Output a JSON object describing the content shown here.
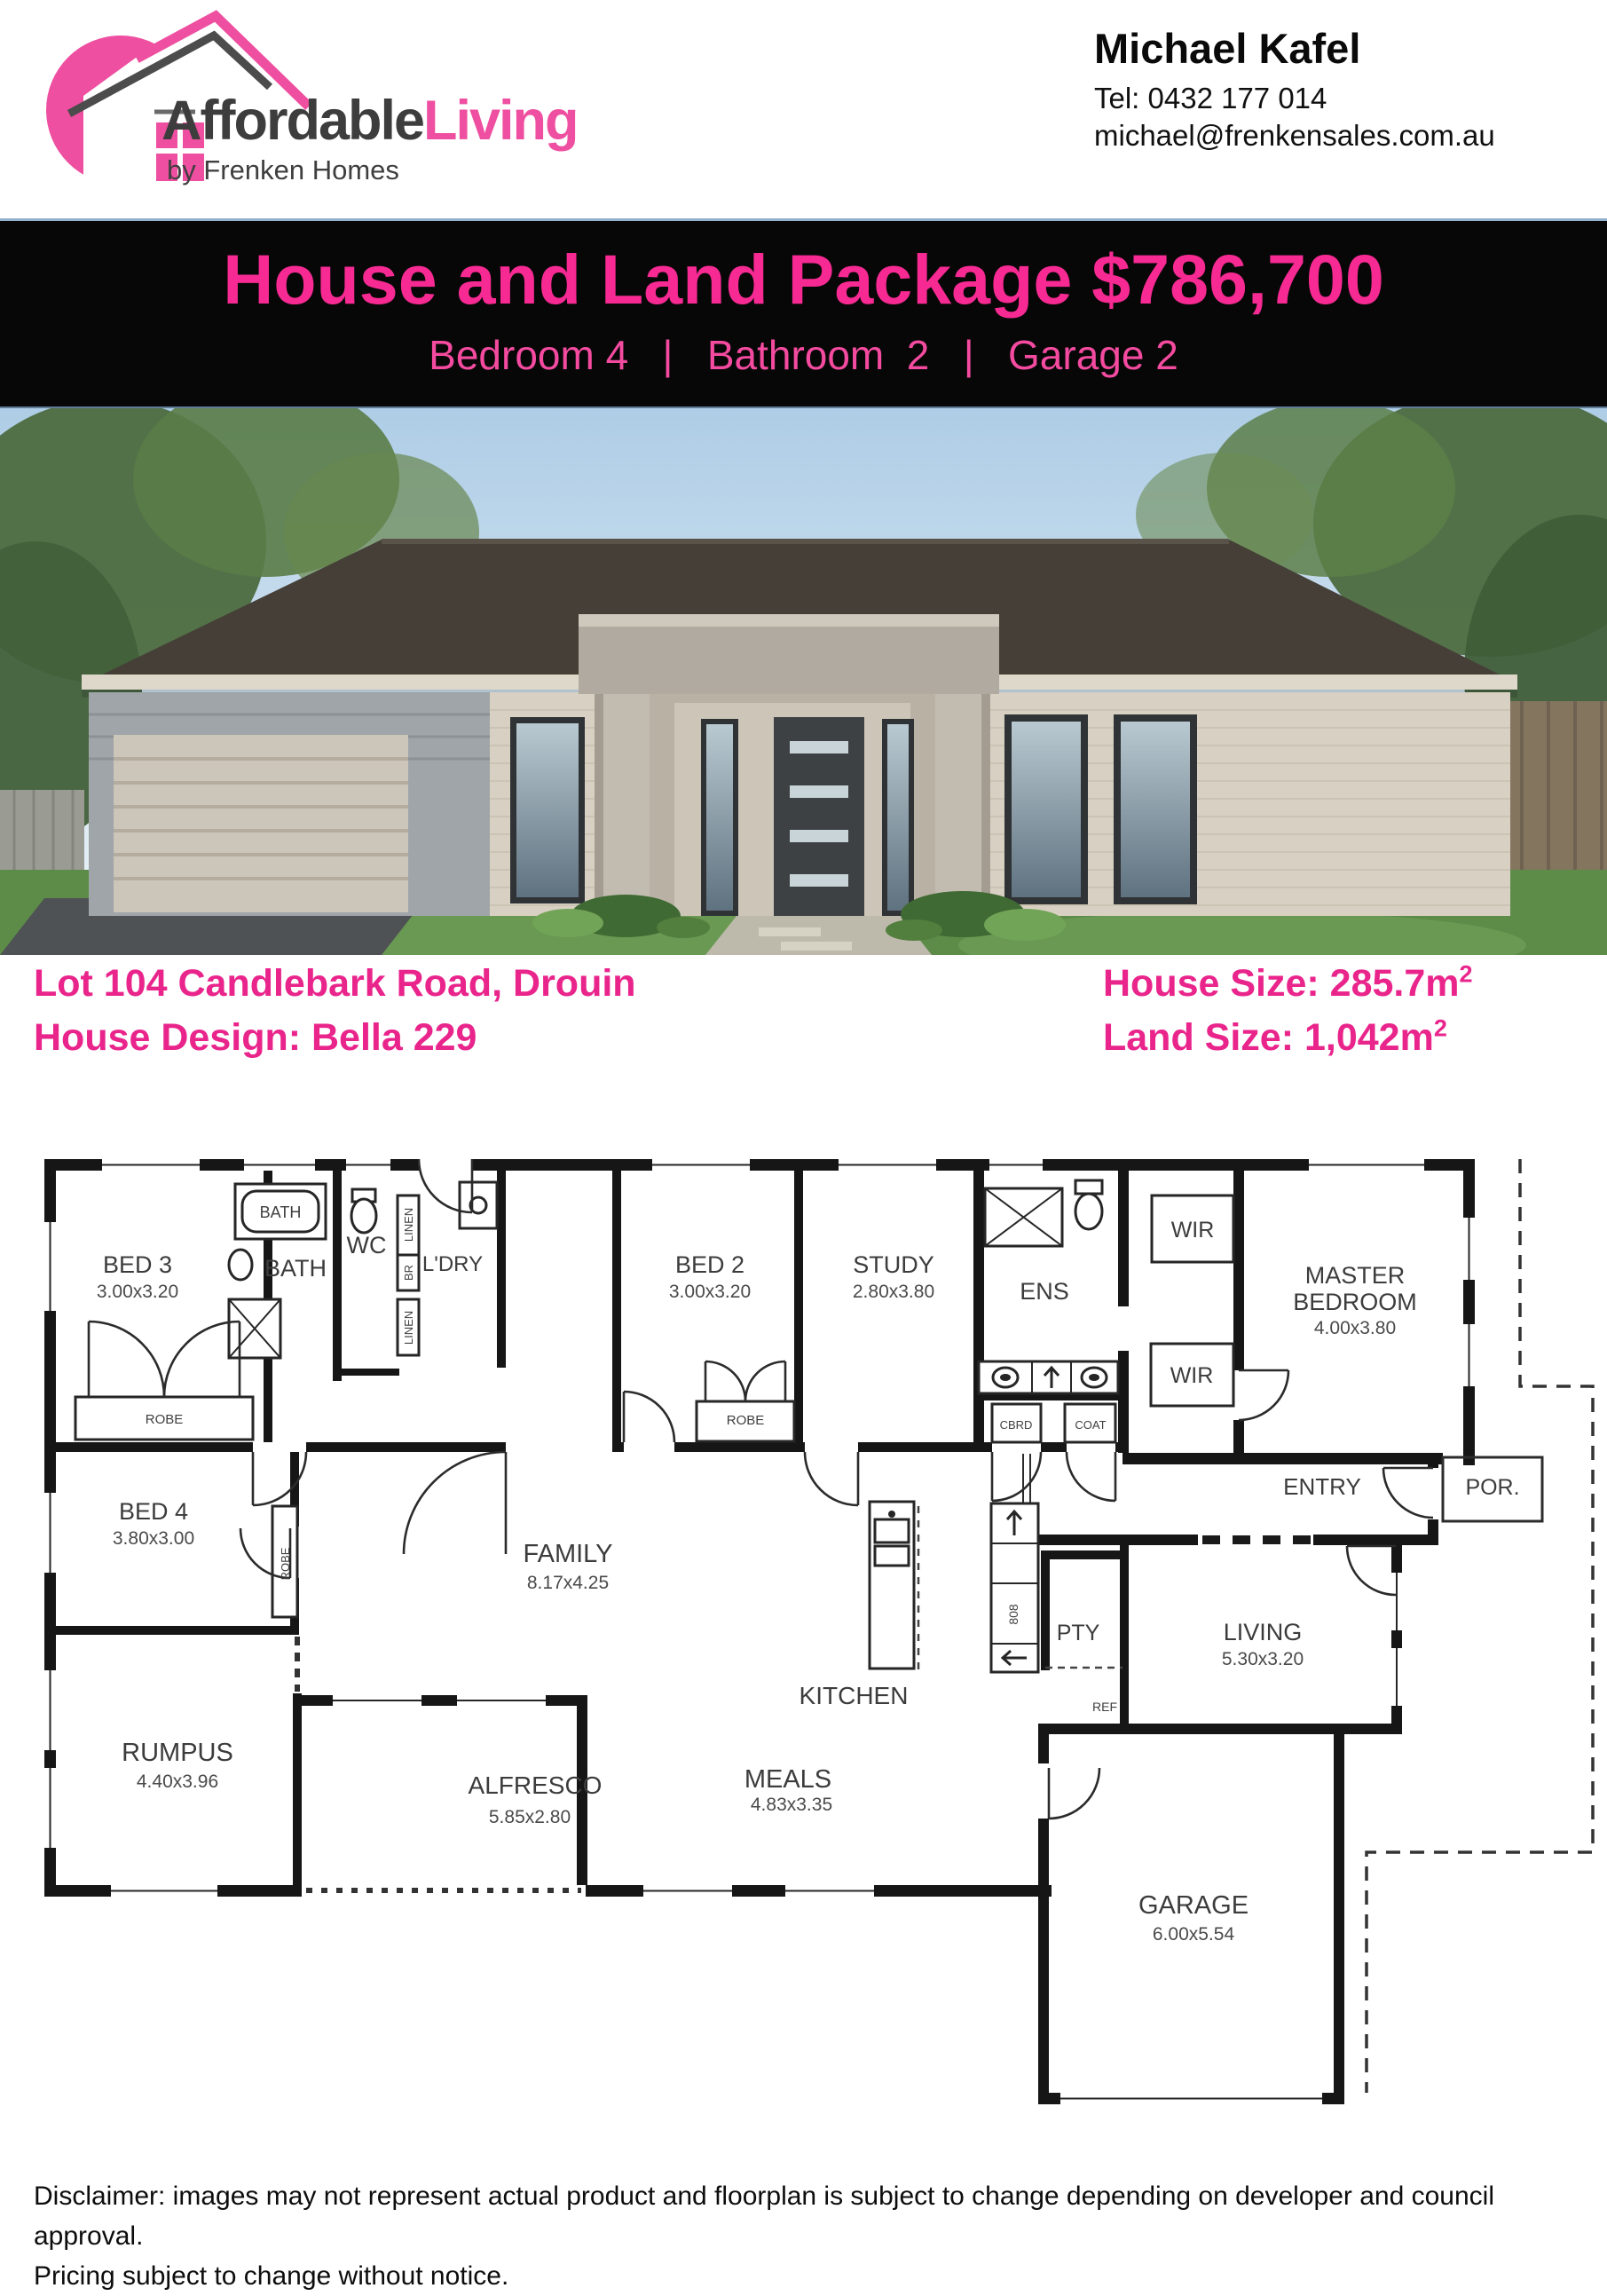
{
  "header": {
    "logo": {
      "icon": "house-roof-icon",
      "brand_dark": "Affordable",
      "brand_pink": "Living",
      "tagline": "by Frenken Homes"
    },
    "agent": {
      "name": "Michael Kafel",
      "phone": "Tel: 0432 177 014",
      "email": "michael@frenkensales.com.au"
    }
  },
  "banner": {
    "title": "House and Land Package $786,700",
    "subtitle": "Bedroom 4   |   Bathroom  2   |   Garage 2"
  },
  "details": {
    "address": "Lot 104 Candlebark Road, Drouin",
    "design": "House Design: Bella 229",
    "house_size_label": "House Size: 285.7m",
    "house_size_sup": "2",
    "land_size_label": "Land Size: 1,042m",
    "land_size_sup": "2"
  },
  "floorplan": {
    "labels": {
      "bed3": "BED 3",
      "bed3_dims": "3.00x3.20",
      "bath_tub": "BATH",
      "bath": "BATH",
      "wc": "WC",
      "linen1": "LINEN",
      "br": "BR",
      "linen2": "LINEN",
      "ldry": "L'DRY",
      "robe1": "ROBE",
      "bed2": "BED 2",
      "bed2_dims": "3.00x3.20",
      "robe2": "ROBE",
      "study": "STUDY",
      "study_dims": "2.80x3.80",
      "ens": "ENS",
      "cbrd": "CBRD",
      "coat": "COAT",
      "wir1": "WIR",
      "wir2": "WIR",
      "master1": "MASTER",
      "master2": "BEDROOM",
      "master_dims": "4.00x3.80",
      "entry": "ENTRY",
      "por": "POR.",
      "bed4": "BED 4",
      "bed4_dims": "3.80x3.00",
      "robe4": "ROBE",
      "family": "FAMILY",
      "family_dims": "8.17x4.25",
      "kitchen": "KITCHEN",
      "pty": "PTY",
      "ref": "REF",
      "living": "LIVING",
      "living_dims": "5.30x3.20",
      "rumpus": "RUMPUS",
      "rumpus_dims": "4.40x3.96",
      "alfresco": "ALFRESCO",
      "alfresco_dims": "5.85x2.80",
      "meals": "MEALS",
      "meals_dims": "4.83x3.35",
      "garage": "GARAGE",
      "garage_dims": "6.00x5.54",
      "appliances": "808"
    }
  },
  "disclaimer": {
    "line1": "Disclaimer: images may not represent actual product and floorplan is subject to change depending on developer and council approval.",
    "line2": "Pricing subject to change without notice."
  },
  "colors": {
    "brand_pink": "#ee4fa0",
    "banner_pink": "#f72a93",
    "details_pink": "#e9258c",
    "banner_bg": "#070707"
  }
}
